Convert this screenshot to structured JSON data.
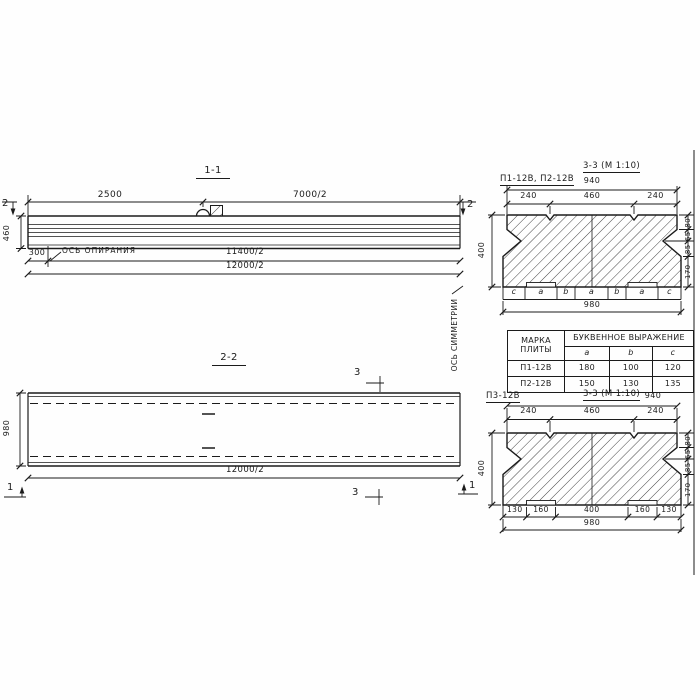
{
  "meta": {
    "ink_color": "#1b1b1b",
    "paper_color": "#fefefe"
  },
  "section_1_1": {
    "title": "1-1",
    "dim_top_left": "2500",
    "dim_top_right": "7000/2",
    "marker_left": "2",
    "marker_right": "2",
    "dim_height": "460",
    "dim_bearing_offset": "300",
    "bearing_axis_label": "ОСЬ ОПИРАНИЯ",
    "dim_lower_1": "11400/2",
    "dim_lower_2": "12000/2",
    "symmetry_axis_label": "ОСЬ СИММЕТРИИ"
  },
  "section_2_2": {
    "title": "2-2",
    "dim_width": "980",
    "dim_length": "12000/2",
    "marker_bottom_left": "1",
    "marker_bottom_right": "1",
    "marker_top": "3",
    "marker_bottom": "3"
  },
  "section_3_3_upper": {
    "plate_marks": "П1-12В, П2-12В",
    "title": "3-3 (М 1:10)",
    "dim_overall_top": "940",
    "dims_top": [
      "240",
      "460",
      "240"
    ],
    "dim_height": "400",
    "dims_right": [
      "80",
      "65",
      "85",
      "170"
    ],
    "letter_row": [
      "c",
      "a",
      "b",
      "a",
      "b",
      "a",
      "c"
    ],
    "dim_overall_bottom": "980"
  },
  "dimension_table": {
    "col_mark": "МАРКА ПЛИТЫ",
    "col_group": "БУКВЕННОЕ ВЫРАЖЕНИЕ",
    "subcols": [
      "a",
      "b",
      "c"
    ],
    "rows": [
      {
        "mark": "П1-12В",
        "a": "180",
        "b": "100",
        "c": "120"
      },
      {
        "mark": "П2-12В",
        "a": "150",
        "b": "130",
        "c": "135"
      }
    ]
  },
  "section_3_3_lower": {
    "plate_mark": "П3-12В",
    "title": "3-3 (М 1:10)",
    "dim_overall_top": "940",
    "dims_top": [
      "240",
      "460",
      "240"
    ],
    "dim_height": "400",
    "dims_right": [
      "80",
      "65",
      "85",
      "170"
    ],
    "dims_bottom": [
      "130",
      "160",
      "400",
      "160",
      "130"
    ],
    "dim_overall_bottom": "980"
  }
}
